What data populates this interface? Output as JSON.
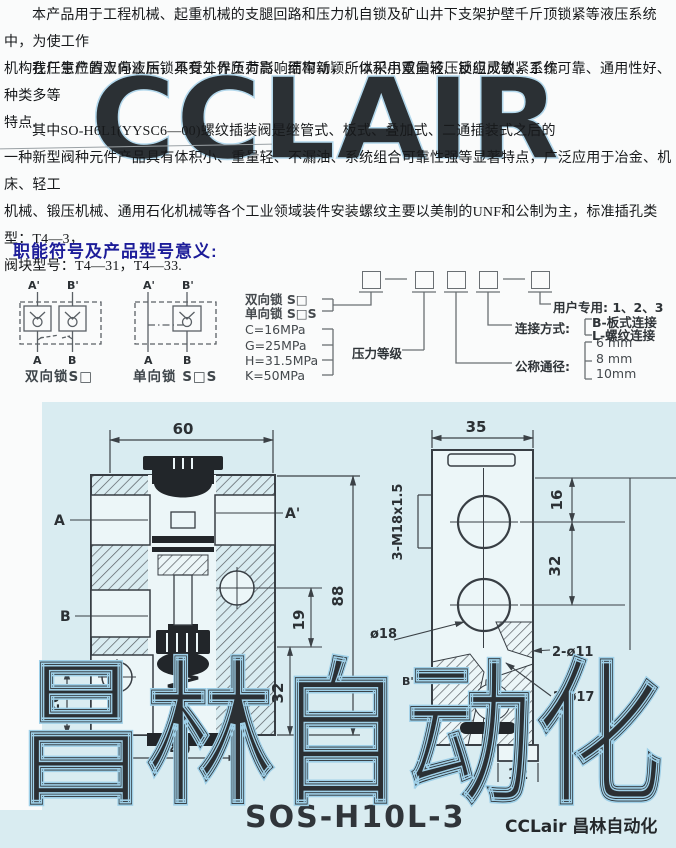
{
  "intro": {
    "para1": "本产品用于工程机械、起重机械的支腿回路和压力机自锁及矿山井下支架护壁千斤顶锁紧等液压系统中，为使工作\n机构在任意位置上停止后，不受外界负荷影响而窜动，所以采用双向液压锁组成锁紧系统.",
    "para2": "我厂生产的双向液压锁具有工作压力高、结构新颖、体积小重量轻、反应灵敏、工作可靠、通用性好、种类多等\n特点.",
    "para3": "其中SO-H6L1(YYSC6—00)螺纹插装阀是继管式、板式、叠加式、二通插装式之后的\n一种新型阀种元件产品具有体积小、重量轻、不漏油、系统组合可靠性强等显著特点，广泛应用于冶金、机床、轻工\n机械、锻压机械、通用石化机械等各个工业领域装件安装螺纹主要以美制的UNF和公制为主，标准插孔类型：T4—3，\n阀块型号：T4—31，T4—33."
  },
  "section": {
    "title": "职能符号及产品型号意义:",
    "symbols": {
      "bidirectional": {
        "caption": "双向锁S□",
        "port_a1": "A'",
        "port_b1": "B'",
        "port_a": "A",
        "port_b": "B"
      },
      "unidirectional": {
        "caption": "单向锁 S□S",
        "port_a1": "A'",
        "port_b1": "B'",
        "port_a": "A",
        "port_b": "B"
      }
    },
    "model_code": {
      "type_line1": "双向锁 S□",
      "type_line2": "单向锁 S□S",
      "pressure_label": "压力等级",
      "pressure_c": "C=16MPa",
      "pressure_g": "G=25MPa",
      "pressure_h": "H=31.5MPa",
      "pressure_k": "K=50MPa",
      "diameter_label": "公称通径:",
      "diameter_6": "6 mm",
      "diameter_8": "8 mm",
      "diameter_10": "10mm",
      "connection_label": "连接方式:",
      "connection_b": "B-板式连接",
      "connection_l": "L-螺纹连接",
      "user_label": "用户专用: 1、2、3"
    }
  },
  "drawing": {
    "model": "SOS-H10L-3",
    "brand": "CCLair 昌林自动化",
    "left_view": {
      "dim_top": "60",
      "dim_right": "88",
      "dim_left": "20",
      "dim_bottom": "40",
      "dim_32": "32",
      "dim_19": "19",
      "port_a": "A",
      "port_a1": "A'",
      "port_b": "B"
    },
    "right_view": {
      "dim_top": "35",
      "dim_16": "16",
      "dim_32": "32",
      "dim_stub": "12",
      "thread_label": "3-M18x1.5",
      "dia18_label": "ø18",
      "port_b1": "B'",
      "holes11_label": "2-ø11",
      "holes17_label": "2-ø17"
    }
  },
  "watermarks": {
    "top": "CCLAIR",
    "bottom": "昌林自动化"
  },
  "colors": {
    "scan_bg": "#d9ecf1",
    "watermark": "#9fd0e8",
    "title_blue": "#1c1c99",
    "line": "#3b4146"
  }
}
